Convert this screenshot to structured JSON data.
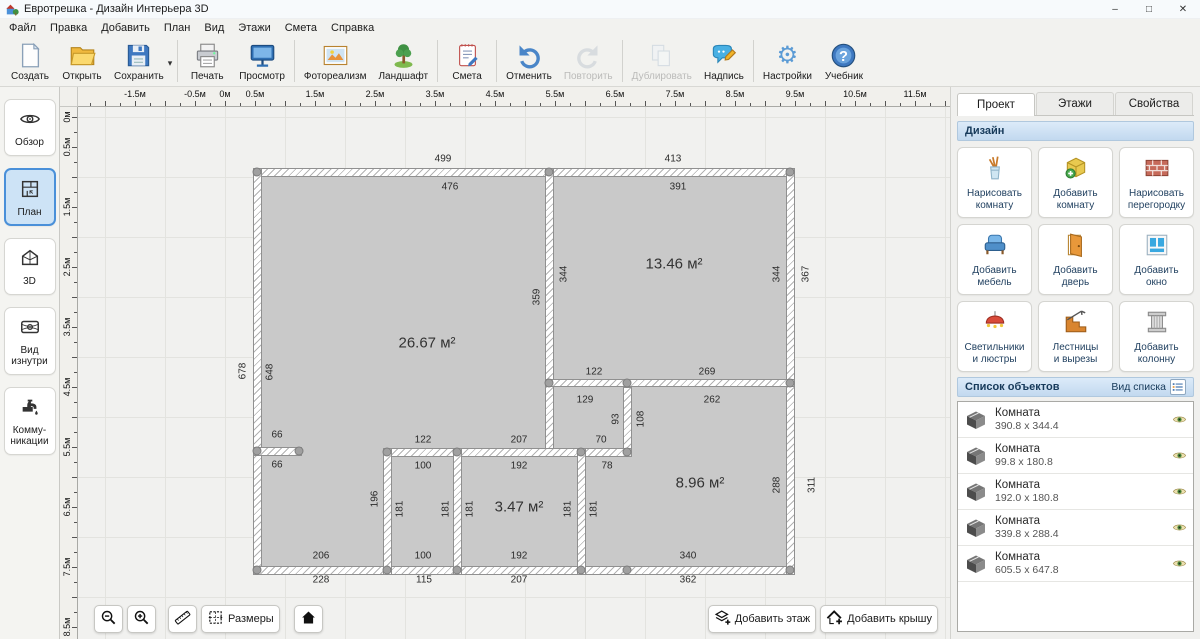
{
  "window": {
    "title": "Евротрешка - Дизайн Интерьера 3D",
    "controls": {
      "minimize": "–",
      "maximize": "□",
      "close": "✕"
    }
  },
  "menu": [
    "Файл",
    "Правка",
    "Добавить",
    "План",
    "Вид",
    "Этажи",
    "Смета",
    "Справка"
  ],
  "toolbar": [
    {
      "name": "create-button",
      "label": "Создать",
      "icon": "new-file",
      "enabled": true
    },
    {
      "name": "open-button",
      "label": "Открыть",
      "icon": "open-folder",
      "enabled": true
    },
    {
      "name": "save-button",
      "label": "Сохранить",
      "icon": "save-floppy",
      "enabled": true,
      "dropdown": "▾"
    },
    {
      "sep": true
    },
    {
      "name": "print-button",
      "label": "Печать",
      "icon": "printer",
      "enabled": true
    },
    {
      "name": "preview-button",
      "label": "Просмотр",
      "icon": "monitor",
      "enabled": true
    },
    {
      "sep": true
    },
    {
      "name": "photorealism-button",
      "label": "Фотореализм",
      "icon": "photo",
      "enabled": true
    },
    {
      "name": "landscape-button",
      "label": "Ландшафт",
      "icon": "tree",
      "enabled": true
    },
    {
      "sep": true
    },
    {
      "name": "estimate-button",
      "label": "Смета",
      "icon": "notepad",
      "enabled": true
    },
    {
      "sep": true
    },
    {
      "name": "undo-button",
      "label": "Отменить",
      "icon": "undo",
      "enabled": true
    },
    {
      "name": "redo-button",
      "label": "Повторить",
      "icon": "redo",
      "enabled": false
    },
    {
      "sep": true
    },
    {
      "name": "duplicate-button",
      "label": "Дублировать",
      "icon": "duplicate",
      "enabled": false
    },
    {
      "name": "label-button",
      "label": "Надпись",
      "icon": "note",
      "enabled": true
    },
    {
      "sep": true
    },
    {
      "name": "settings-button",
      "label": "Настройки",
      "icon": "gear",
      "enabled": true
    },
    {
      "name": "tutorial-button",
      "label": "Учебник",
      "icon": "help",
      "enabled": true
    }
  ],
  "sidebar": [
    {
      "name": "sidebar-item-overview",
      "lines": [
        "Обзор"
      ],
      "icon": "eye",
      "active": false
    },
    {
      "name": "sidebar-item-plan",
      "lines": [
        "План"
      ],
      "icon": "plan",
      "active": true
    },
    {
      "name": "sidebar-item-3d",
      "lines": [
        "3D"
      ],
      "icon": "house3d",
      "active": false
    },
    {
      "name": "sidebar-item-interior",
      "lines": [
        "Вид",
        "изнутри"
      ],
      "icon": "interior",
      "active": false
    },
    {
      "name": "sidebar-item-communications",
      "lines": [
        "Комму-",
        "никации"
      ],
      "icon": "faucet",
      "active": false
    }
  ],
  "rulers": {
    "top": [
      [
        "-1.5м",
        -1.5
      ],
      [
        "-0.5м",
        -0.5
      ],
      [
        "0м",
        0
      ],
      [
        "0.5м",
        0.5
      ],
      [
        "1.5м",
        1.5
      ],
      [
        "2.5м",
        2.5
      ],
      [
        "3.5м",
        3.5
      ],
      [
        "4.5м",
        4.5
      ],
      [
        "5.5м",
        5.5
      ],
      [
        "6.5м",
        6.5
      ],
      [
        "7.5м",
        7.5
      ],
      [
        "8.5м",
        8.5
      ],
      [
        "9.5м",
        9.5
      ],
      [
        "10.5м",
        10.5
      ],
      [
        "11.5м",
        11.5
      ]
    ],
    "left": [
      [
        "0м",
        0
      ],
      [
        "0.5м",
        0.5
      ],
      [
        "1.5м",
        1.5
      ],
      [
        "2.5м",
        2.5
      ],
      [
        "3.5м",
        3.5
      ],
      [
        "4.5м",
        4.5
      ],
      [
        "5.5м",
        5.5
      ],
      [
        "6.5м",
        6.5
      ],
      [
        "7.5м",
        7.5
      ],
      [
        "8.5м",
        8.5
      ]
    ]
  },
  "plan": {
    "interior": [
      262,
      175,
      524,
      389
    ],
    "walls": [
      [
        253,
        166,
        542,
        9
      ],
      [
        253,
        166,
        9,
        407
      ],
      [
        253,
        564,
        542,
        9
      ],
      [
        786,
        166,
        9,
        407
      ],
      [
        545,
        166,
        9,
        289
      ],
      [
        545,
        377,
        250,
        8
      ],
      [
        623,
        385,
        9,
        70
      ],
      [
        383,
        446,
        249,
        9
      ],
      [
        253,
        445,
        49,
        9
      ],
      [
        383,
        446,
        9,
        127
      ],
      [
        453,
        446,
        9,
        127
      ],
      [
        577,
        446,
        9,
        127
      ]
    ],
    "handles": [
      [
        257,
        170
      ],
      [
        549,
        170
      ],
      [
        790,
        170
      ],
      [
        549,
        381
      ],
      [
        627,
        381
      ],
      [
        790,
        381
      ],
      [
        257,
        449
      ],
      [
        299,
        449
      ],
      [
        387,
        450
      ],
      [
        457,
        450
      ],
      [
        581,
        450
      ],
      [
        627,
        450
      ],
      [
        257,
        568
      ],
      [
        387,
        568
      ],
      [
        457,
        568
      ],
      [
        581,
        568
      ],
      [
        627,
        568
      ],
      [
        790,
        568
      ]
    ],
    "dims": [
      [
        "499",
        443,
        157,
        0
      ],
      [
        "413",
        673,
        157,
        0
      ],
      [
        "476",
        450,
        185,
        0
      ],
      [
        "391",
        678,
        185,
        0
      ],
      [
        "122",
        594,
        370,
        0
      ],
      [
        "269",
        707,
        370,
        0
      ],
      [
        "129",
        585,
        398,
        0
      ],
      [
        "262",
        712,
        398,
        0
      ],
      [
        "66",
        277,
        433,
        0
      ],
      [
        "122",
        423,
        438,
        0
      ],
      [
        "207",
        519,
        438,
        0
      ],
      [
        "70",
        601,
        438,
        0
      ],
      [
        "66",
        277,
        463,
        0
      ],
      [
        "100",
        423,
        464,
        0
      ],
      [
        "192",
        519,
        464,
        0
      ],
      [
        "78",
        607,
        464,
        0
      ],
      [
        "206",
        321,
        554,
        0
      ],
      [
        "100",
        423,
        554,
        0
      ],
      [
        "192",
        519,
        554,
        0
      ],
      [
        "340",
        688,
        554,
        0
      ],
      [
        "228",
        321,
        578,
        0
      ],
      [
        "115",
        424,
        578,
        0
      ],
      [
        "207",
        519,
        578,
        0
      ],
      [
        "362",
        688,
        578,
        0
      ],
      [
        "678",
        243,
        369,
        1
      ],
      [
        "648",
        270,
        370,
        1
      ],
      [
        "359",
        537,
        295,
        1
      ],
      [
        "344",
        564,
        272,
        1
      ],
      [
        "344",
        777,
        272,
        1
      ],
      [
        "367",
        806,
        272,
        1
      ],
      [
        "93",
        616,
        417,
        1
      ],
      [
        "108",
        641,
        417,
        1
      ],
      [
        "196",
        375,
        497,
        1
      ],
      [
        "181",
        400,
        507,
        1
      ],
      [
        "181",
        446,
        507,
        1
      ],
      [
        "181",
        470,
        507,
        1
      ],
      [
        "181",
        568,
        507,
        1
      ],
      [
        "181",
        594,
        507,
        1
      ],
      [
        "288",
        777,
        483,
        1
      ],
      [
        "311",
        812,
        483,
        1
      ]
    ],
    "rooms": [
      [
        "26.67 м²",
        427,
        341
      ],
      [
        "13.46 м²",
        674,
        262
      ],
      [
        "3.47 м²",
        519,
        505
      ],
      [
        "8.96 м²",
        700,
        481
      ]
    ]
  },
  "right_panel": {
    "tabs": [
      {
        "name": "tab-project",
        "label": "Проект",
        "active": true
      },
      {
        "name": "tab-floors",
        "label": "Этажи",
        "active": false
      },
      {
        "name": "tab-properties",
        "label": "Свойства",
        "active": false
      }
    ],
    "design": {
      "title": "Дизайн",
      "buttons": [
        {
          "name": "draw-room-button",
          "lines": [
            "Нарисовать",
            "комнату"
          ],
          "icon": "draw-room"
        },
        {
          "name": "add-room-button",
          "lines": [
            "Добавить",
            "комнату"
          ],
          "icon": "add-room"
        },
        {
          "name": "draw-partition-button",
          "lines": [
            "Нарисовать",
            "перегородку"
          ],
          "icon": "partition"
        },
        {
          "name": "add-furniture-button",
          "lines": [
            "Добавить",
            "мебель"
          ],
          "icon": "furniture"
        },
        {
          "name": "add-door-button",
          "lines": [
            "Добавить",
            "дверь"
          ],
          "icon": "door"
        },
        {
          "name": "add-window-button",
          "lines": [
            "Добавить",
            "окно"
          ],
          "icon": "window"
        },
        {
          "name": "lights-button",
          "lines": [
            "Светильники",
            "и люстры"
          ],
          "icon": "chandelier"
        },
        {
          "name": "stairs-button",
          "lines": [
            "Лестницы",
            "и вырезы"
          ],
          "icon": "stairs"
        },
        {
          "name": "add-column-button",
          "lines": [
            "Добавить",
            "колонну"
          ],
          "icon": "column"
        }
      ]
    },
    "objects": {
      "title": "Список объектов",
      "view_label": "Вид списка",
      "items": [
        {
          "name": "Комната",
          "dims": "390.8 x 344.4"
        },
        {
          "name": "Комната",
          "dims": "99.8 x 180.8"
        },
        {
          "name": "Комната",
          "dims": "192.0 x 180.8"
        },
        {
          "name": "Комната",
          "dims": "339.8 x 288.4"
        },
        {
          "name": "Комната",
          "dims": "605.5 x 647.8"
        }
      ]
    }
  },
  "bottom": {
    "left": [
      {
        "name": "zoom-out-button",
        "icon": "zoom-out",
        "label": "",
        "gap": 8
      },
      {
        "name": "zoom-in-button",
        "icon": "zoom-in",
        "label": "",
        "gap": 0
      },
      {
        "name": "ruler-button",
        "icon": "ruler",
        "label": "",
        "gap": 8
      },
      {
        "name": "dimensions-button",
        "icon": "dims",
        "label": "Размеры",
        "gap": 0
      },
      {
        "name": "home-button",
        "icon": "home",
        "label": "",
        "gap": 10
      }
    ],
    "right": [
      {
        "name": "add-floor-button",
        "icon": "add-floor",
        "label": "Добавить этаж"
      },
      {
        "name": "add-roof-button",
        "icon": "add-roof",
        "label": "Добавить крышу"
      }
    ]
  }
}
